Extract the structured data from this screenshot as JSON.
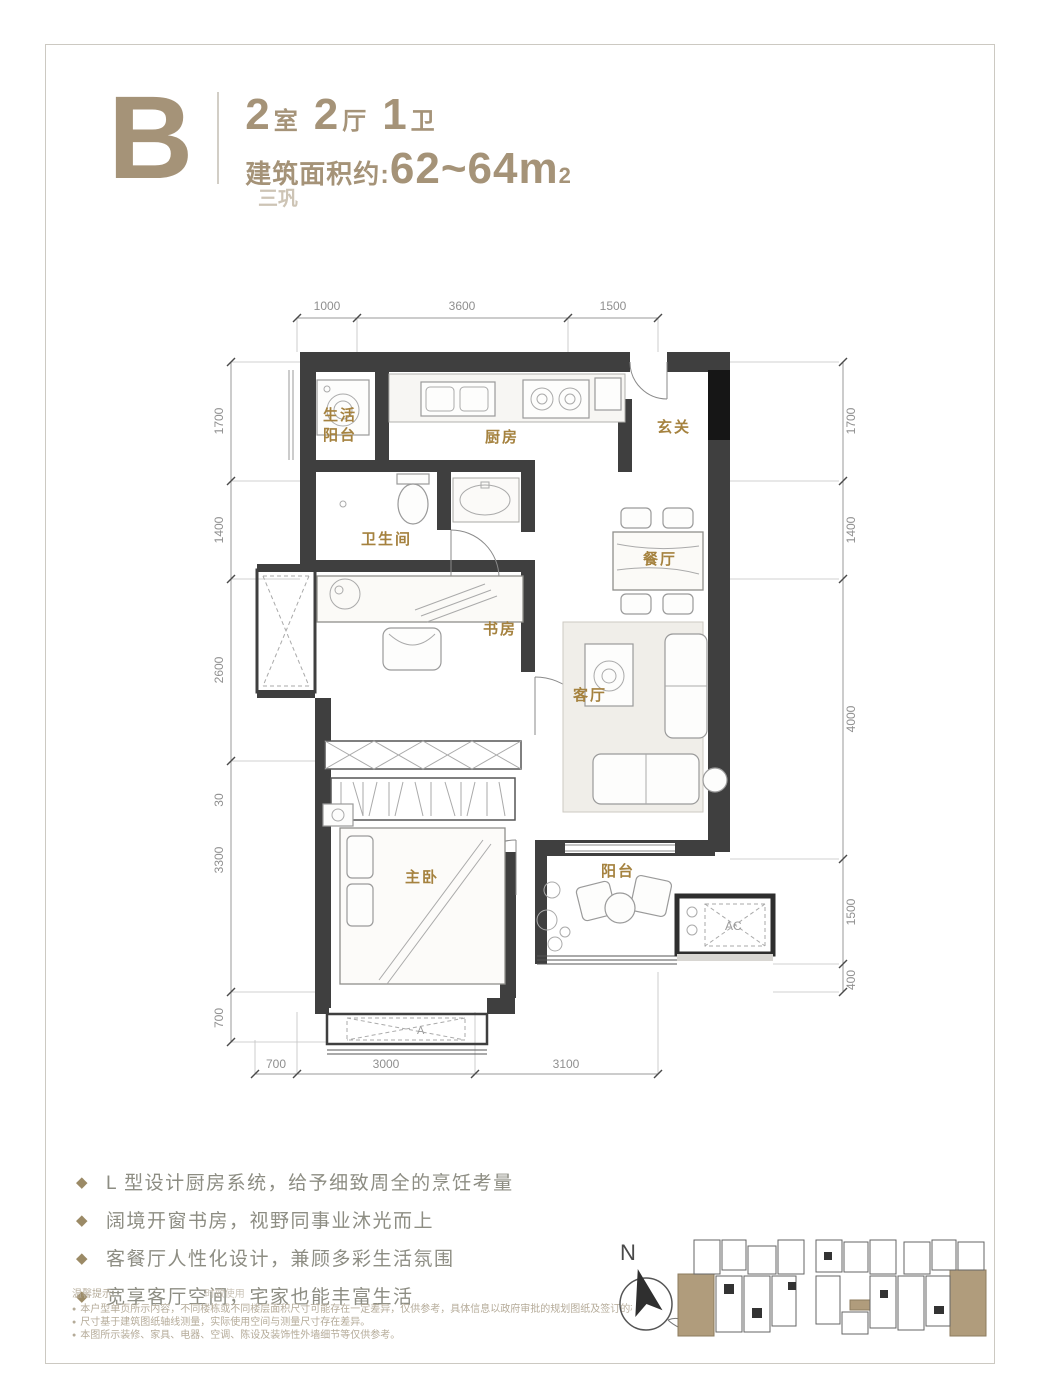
{
  "header": {
    "unit_letter": "B",
    "rooms_num": "2",
    "rooms_unit": "室",
    "halls_num": "2",
    "halls_unit": "厅",
    "baths_num": "1",
    "baths_unit": "卫",
    "area_label": "建筑面积约:",
    "area_value": "62~64m",
    "area_sup": "2",
    "watermark": "三巩"
  },
  "plan": {
    "rooms": {
      "life_balcony_l1": "生活",
      "life_balcony_l2": "阳台",
      "kitchen": "厨房",
      "foyer": "玄关",
      "bathroom": "卫生间",
      "dining": "餐厅",
      "study": "书房",
      "living": "客厅",
      "master": "主卧",
      "balcony": "阳台",
      "ac": "AC",
      "bay_mark": "A"
    },
    "dims": {
      "top": [
        "1000",
        "3600",
        "1500"
      ],
      "bottom": [
        "700",
        "3000",
        "3100"
      ],
      "left": [
        "1700",
        "1400",
        "2600",
        "30",
        "3300",
        "700"
      ],
      "right": [
        "1700",
        "1400",
        "4000",
        "1500",
        "400"
      ]
    },
    "compass_n": "N"
  },
  "features": {
    "items": [
      "L 型设计厨房系统，给予细致周全的烹饪考量",
      "阔境开窗书房，视野同事业沐光而上",
      "客餐厅人性化设计，兼顾多彩生活氛围",
      "宽享客厅空间，宅家也能丰富生活"
    ]
  },
  "disclaimer": {
    "title": "温馨提示:",
    "watermark": "时效使用",
    "items": [
      "本户型单页所示内容，不同楼栋或不同楼层面积尺寸可能存在一定差异，仅供参考，具体信息以政府审批的规划图纸及签订的相关文件为准。",
      "尺寸基于建筑图纸轴线测量，实际使用空间与测量尺寸存在差异。",
      "本图所示装修、家具、电器、空调、陈设及装饰性外墙细节等仅供参考。"
    ]
  },
  "colors": {
    "accent_tan": "#a59378",
    "room_label_gold": "#a5823f",
    "wall_dark": "#3f3f3f",
    "dim_gray": "#8f8f8f",
    "fine_print": "#b5ab99",
    "site_highlight": "#b09c7c"
  }
}
